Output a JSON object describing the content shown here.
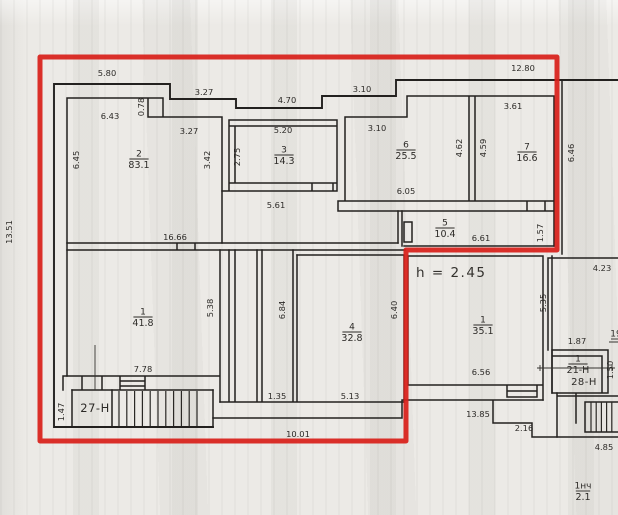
{
  "colors": {
    "paper": "#ECEAE6",
    "ink": "#23211F",
    "red_outline": "#D8201A"
  },
  "plan": {
    "annotation": {
      "text": "h = 2.45",
      "x": 416,
      "y": 277
    },
    "rooms": [
      {
        "number": "2",
        "area": "83.1",
        "x": 139,
        "y": 159
      },
      {
        "number": "3",
        "area": "14.3",
        "x": 284,
        "y": 155
      },
      {
        "number": "6",
        "area": "25.5",
        "x": 406,
        "y": 150
      },
      {
        "number": "7",
        "area": "16.6",
        "x": 527,
        "y": 152
      },
      {
        "number": "5",
        "area": "10.4",
        "x": 445,
        "y": 228
      },
      {
        "number": "1",
        "area": "41.8",
        "x": 143,
        "y": 317
      },
      {
        "number": "4",
        "area": "32.8",
        "x": 352,
        "y": 332
      },
      {
        "number": "1",
        "area": "35.1",
        "x": 483,
        "y": 325
      },
      {
        "number": "1",
        "area": "21-Н",
        "x": 578,
        "y": 364
      },
      {
        "number": "19",
        "area": "",
        "x": 616,
        "y": 339
      },
      {
        "number": "1нч",
        "area": "2.1",
        "x": 583,
        "y": 491
      }
    ],
    "unit_labels": [
      {
        "text": "27-Н",
        "x": 95,
        "y": 412,
        "small": false
      },
      {
        "text": "28-Н",
        "x": 584,
        "y": 385,
        "small": true
      }
    ],
    "dimensions": [
      {
        "text": "5.80",
        "x": 107,
        "y": 76,
        "rot": false
      },
      {
        "text": "3.27",
        "x": 204,
        "y": 95,
        "rot": false
      },
      {
        "text": "4.70",
        "x": 287,
        "y": 103,
        "rot": false
      },
      {
        "text": "3.10",
        "x": 362,
        "y": 92,
        "rot": false
      },
      {
        "text": "12.80",
        "x": 523,
        "y": 71,
        "rot": false
      },
      {
        "text": "3.61",
        "x": 513,
        "y": 109,
        "rot": false
      },
      {
        "text": "6.43",
        "x": 110,
        "y": 119,
        "rot": false
      },
      {
        "text": "0.78",
        "x": 144,
        "y": 107,
        "rot": true
      },
      {
        "text": "3.27",
        "x": 189,
        "y": 134,
        "rot": false
      },
      {
        "text": "3.10",
        "x": 377,
        "y": 131,
        "rot": false
      },
      {
        "text": "5.20",
        "x": 283,
        "y": 133,
        "rot": false
      },
      {
        "text": "6.45",
        "x": 79,
        "y": 160,
        "rot": true
      },
      {
        "text": "3.42",
        "x": 210,
        "y": 160,
        "rot": true
      },
      {
        "text": "2.75",
        "x": 240,
        "y": 157,
        "rot": true
      },
      {
        "text": "4.62",
        "x": 462,
        "y": 148,
        "rot": true
      },
      {
        "text": "4.59",
        "x": 486,
        "y": 148,
        "rot": true
      },
      {
        "text": "6.46",
        "x": 574,
        "y": 153,
        "rot": true
      },
      {
        "text": "6.05",
        "x": 406,
        "y": 194,
        "rot": false
      },
      {
        "text": "5.61",
        "x": 276,
        "y": 208,
        "rot": false
      },
      {
        "text": "16.66",
        "x": 175,
        "y": 240,
        "rot": false
      },
      {
        "text": "6.61",
        "x": 481,
        "y": 241,
        "rot": false
      },
      {
        "text": "1.57",
        "x": 543,
        "y": 233,
        "rot": true
      },
      {
        "text": "5.38",
        "x": 213,
        "y": 308,
        "rot": true
      },
      {
        "text": "6.84",
        "x": 285,
        "y": 310,
        "rot": true
      },
      {
        "text": "6.40",
        "x": 397,
        "y": 310,
        "rot": true
      },
      {
        "text": "5.35",
        "x": 546,
        "y": 303,
        "rot": true
      },
      {
        "text": "4.23",
        "x": 602,
        "y": 271,
        "rot": false
      },
      {
        "text": "1.87",
        "x": 577,
        "y": 344,
        "rot": false
      },
      {
        "text": "1.50",
        "x": 613,
        "y": 370,
        "rot": true
      },
      {
        "text": "7.78",
        "x": 143,
        "y": 372,
        "rot": false
      },
      {
        "text": "1.47",
        "x": 64,
        "y": 412,
        "rot": true
      },
      {
        "text": "1.35",
        "x": 277,
        "y": 399,
        "rot": false
      },
      {
        "text": "5.13",
        "x": 350,
        "y": 399,
        "rot": false
      },
      {
        "text": "6.56",
        "x": 481,
        "y": 375,
        "rot": false
      },
      {
        "text": "13.85",
        "x": 478,
        "y": 417,
        "rot": false
      },
      {
        "text": "2.16",
        "x": 524,
        "y": 431,
        "rot": false
      },
      {
        "text": "4.85",
        "x": 604,
        "y": 450,
        "rot": false
      },
      {
        "text": "10.01",
        "x": 298,
        "y": 437,
        "rot": false
      },
      {
        "text": "13.51",
        "x": 12,
        "y": 232,
        "rot": true
      }
    ]
  }
}
